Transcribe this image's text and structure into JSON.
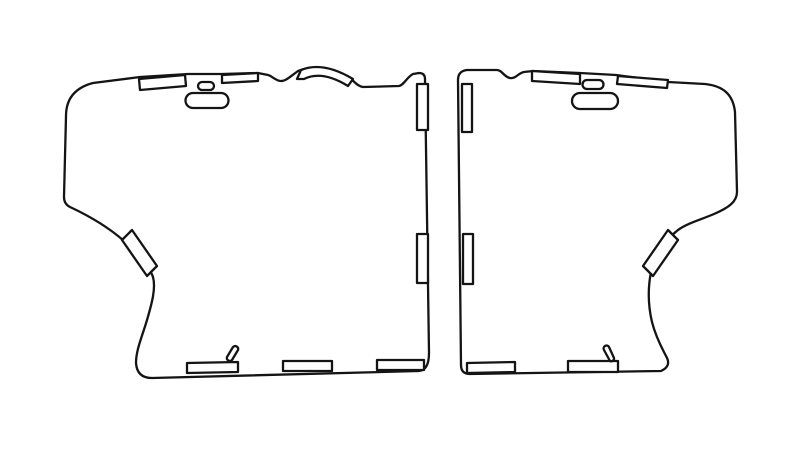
{
  "page": {
    "background": "#ffffff",
    "description": "Technical line drawing of two mirrored panel pattern pieces with edge tabs, slots and diagonal strips"
  },
  "drawing": {
    "ink": "#141414",
    "paper": "#ffffff",
    "canvas": {
      "width": 800,
      "height": 453
    },
    "left_panel": {
      "outline": "M93,83 L140,77 L188,74 L222,74 L258,73 L268,75 C272,76 276,81 281,81 C286,81 291,76 298,71 Q321,62 352,80 C355,82 357,86 363,87 L399,86 C404,85 407,77 413,74 L419,73 Q425,73 425,79 L429,353 Q429,370 419,371 L152,378 Q137,378 136,363 C136,350 142,337 147,320 C152,303 156,288 153,277 C150,268 140,256 124,241 C106,225 85,214 70,207 Q64,204 64,197 L66,116 C66,100 74,88 93,83 Z",
      "ear_band": "M297,79 L301,70 Q323,61 353,79 L348,86 Q322,70 304,79 Z",
      "top_tab_a": "M139,79 L185,75 L186,86 L140,90 Z",
      "top_tab_b": "M222,75 L258,73 L258,81 L222,83 Z",
      "small_slot": "M202,82 L210,82 A4,4 0 0 1 210,90 L202,90 A4,4 0 0 1 202,82 Z",
      "pill_slot": "M193,93 L221,93 A7.5,7.5 0 0 1 221,108 L193,108 A7.5,7.5 0 0 1 193,93 Z",
      "side_tab_top": "M417,84 L428,84 L428,130 L417,130 Z",
      "side_tab_mid": "M417,234 L428,234 L428,283 L417,283 Z",
      "hip_strip": "M122,240 L132,230 L157,266 L147,276 Z",
      "bottom_tab_a": "M187,363 L238,362 L238,372 L187,373 Z",
      "bottom_tab_b": "M283,361 L332,361 L332,371 L283,371 Z",
      "bottom_tab_c": "M377,360 L424,360 L424,370 L377,370 Z",
      "bottom_sliver": "M227,357 L233,347 A3,3 0 0 1 238,350 L232,360 A3,3 0 0 1 227,357 Z"
    },
    "right_panel": {
      "outline": "M467,70 L497,70 C502,70 504,77 510,78 C516,79 518,73 524,72 L533,71 L580,73 L616,75 L668,82 L705,84 C723,86 733,94 735,112 L737,192 C737,202 728,208 714,214 C700,220 688,223 678,230 C664,241 655,255 651,272 C648,287 648,305 652,322 C656,338 663,350 666,356 Q672,366 661,371 L470,374 Q461,374 461,365 L458,80 Q458,71 467,70 Z",
      "top_tab_a": "M532,71 L580,74 L580,84 L532,81 Z",
      "top_tab_b": "M618,76 L668,80 L667,88 L617,84 Z",
      "small_slot": "M587,80 L599,80 A4.5,4.5 0 0 1 599,89 L587,89 A4.5,4.5 0 0 1 587,80 Z",
      "pill_slot": "M580,93 L610,93 A8,8 0 0 1 610,109 L580,109 A8,8 0 0 1 580,93 Z",
      "side_tab_top": "M462,84 L472,84 L472,132 L462,132 Z",
      "side_tab_mid": "M463,234 L473,234 L473,284 L463,284 Z",
      "hip_strip": "M668,230 L678,240 L653,276 L643,266 Z",
      "bottom_tab_a": "M467,363 L515,362 L515,372 L467,373 Z",
      "bottom_tab_b": "M568,361 L618,361 L618,372 L568,372 Z",
      "bottom_sliver": "M604,350 A2.8,2.8 0 0 1 609,347 L614,358 A2.8,2.8 0 0 1 610,361 Z"
    }
  }
}
